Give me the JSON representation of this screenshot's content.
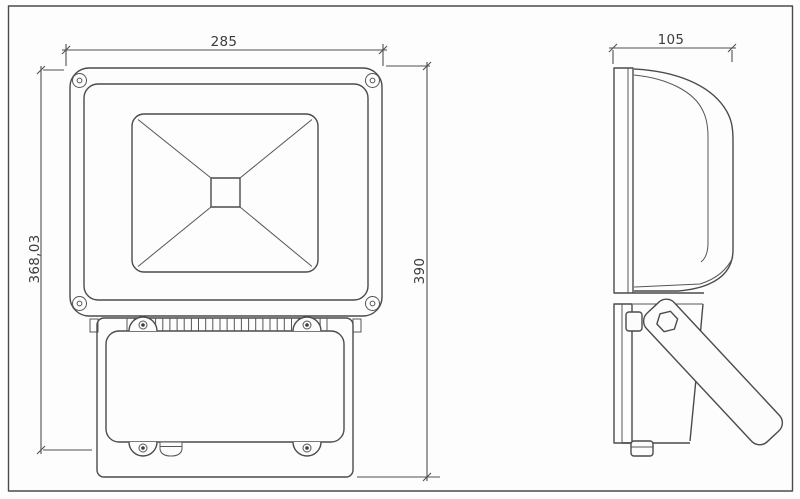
{
  "drawing": {
    "front_view": {
      "dim_width": "285",
      "dim_height_left": "368,03",
      "dim_height_right": "390"
    },
    "side_view": {
      "dim_depth": "105"
    },
    "colors": {
      "line": "#4b4b4b",
      "dimension_line": "#4f4f4f",
      "text": "#3c3c3c",
      "background": "#fdfdfd"
    }
  }
}
